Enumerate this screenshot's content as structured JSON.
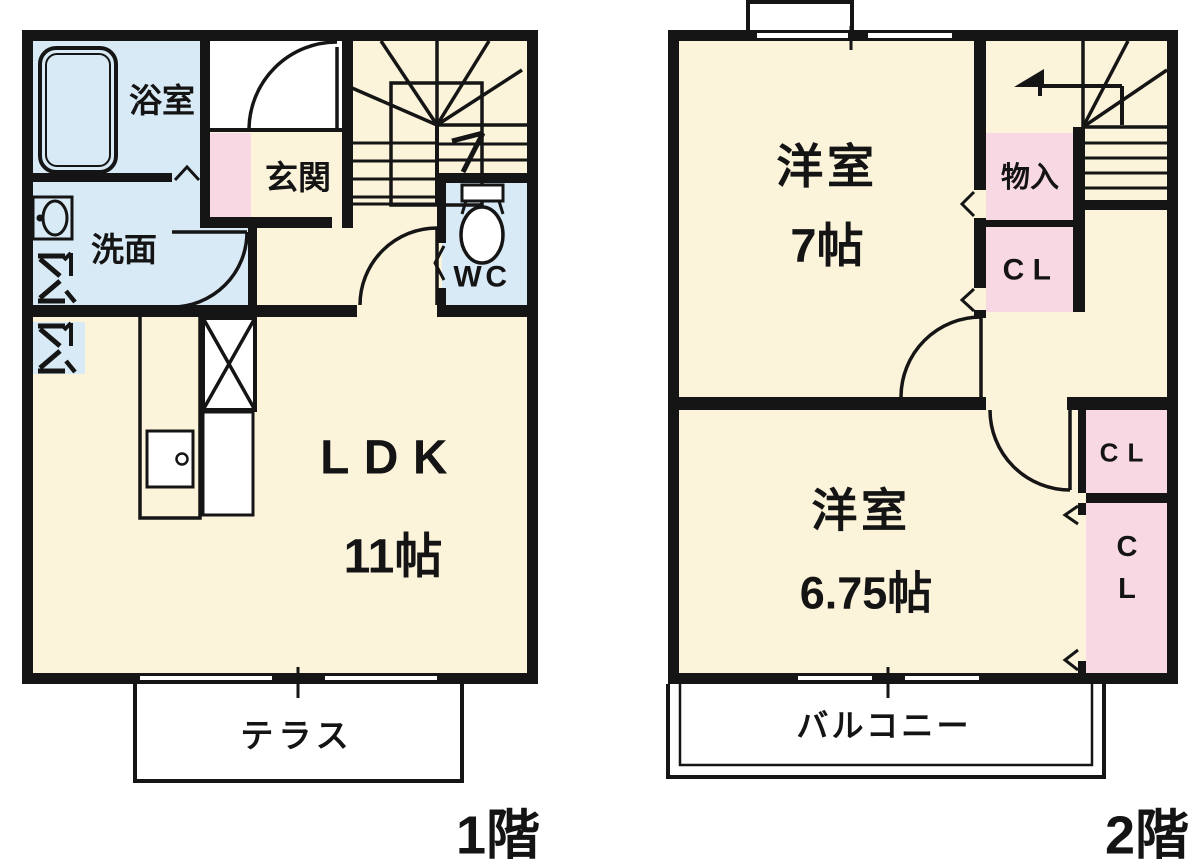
{
  "floor1": {
    "label": "1階",
    "rooms": {
      "bathroom": "浴室",
      "washroom": "洗面",
      "entrance": "玄関",
      "toilet": "WC",
      "living": "LDK",
      "living_size": "11帖",
      "terrace": "テラス"
    }
  },
  "floor2": {
    "label": "2階",
    "rooms": {
      "bedroom_a": "洋室",
      "bedroom_a_size": "7帖",
      "storage": "物入",
      "closet_a": "CL",
      "bedroom_b": "洋室",
      "bedroom_b_size": "6.75帖",
      "closet_b": "CL",
      "closet_c_line1": "C",
      "closet_c_line2": "L",
      "balcony": "バルコニー"
    }
  },
  "colors": {
    "room_fill": "#fbf3da",
    "wet_area_fill": "#d8eaf6",
    "closet_fill": "#f8d8e3",
    "wall": "#151515",
    "exterior": "#ffffff"
  }
}
